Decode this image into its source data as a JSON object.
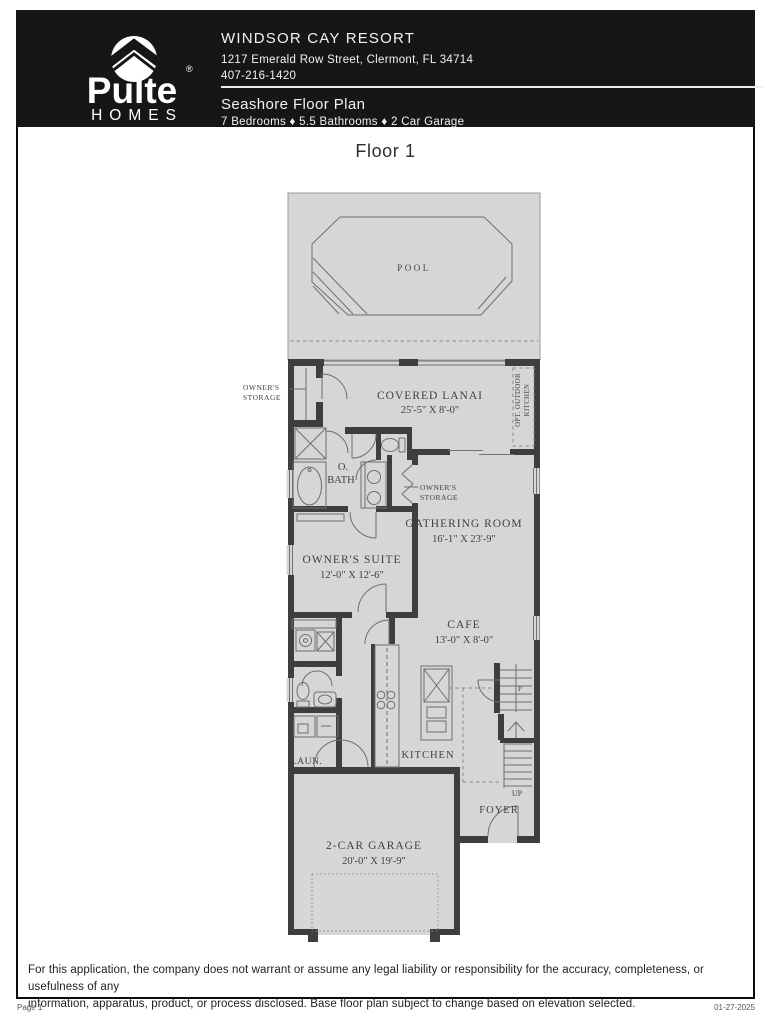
{
  "header": {
    "logo": {
      "brand": "Pulte",
      "sub": "HOMES",
      "registered": "®"
    },
    "community": "WINDSOR CAY RESORT",
    "address": "1217 Emerald Row Street, Clermont, FL 34714",
    "phone": "407-216-1420",
    "plan_name": "Seashore Floor Plan",
    "specs": "7 Bedrooms ♦ 5.5 Bathrooms ♦ 2 Car Garage"
  },
  "floor_title": "Floor 1",
  "plan": {
    "pool": "POOL",
    "storage_left": {
      "line1": "OWNER'S",
      "line2": "STORAGE"
    },
    "lanai": {
      "name": "COVERED LANAI",
      "dims": "25'-5\" X 8'-0\""
    },
    "opt_kitchen": {
      "line1": "OPT. OUTDOOR",
      "line2": "KITCHEN"
    },
    "obath": {
      "line1": "O.",
      "line2": "BATH"
    },
    "storage_inner": {
      "line1": "OWNER'S",
      "line2": "STORAGE"
    },
    "gathering": {
      "name": "GATHERING ROOM",
      "dims": "16'-1\" X 23'-9\""
    },
    "suite": {
      "name": "OWNER'S SUITE",
      "dims": "12'-0\" X 12'-6\""
    },
    "cafe": {
      "name": "CAFE",
      "dims": "13'-0\" X 8'-0\""
    },
    "kitchen": "KITCHEN",
    "laundry": "LAUN.",
    "foyer": "FOYER",
    "up": "UP",
    "pantry": "P",
    "garage": {
      "name": "2-CAR GARAGE",
      "dims": "20'-0\" X 19'-9\""
    }
  },
  "footer": {
    "disclaimer_line1": "For this application, the company does not warrant or assume any legal liability or responsibility for the accuracy, completeness, or usefulness of any",
    "disclaimer_line2": "information, apparatus, product, or process disclosed. Base floor plan subject to change based on elevation selected.",
    "page": "Page 1",
    "date": "01-27-2025"
  },
  "colors": {
    "header_bg": "#161616",
    "floor_fill": "#d6d6d6",
    "wall": "#3e3e3e"
  }
}
